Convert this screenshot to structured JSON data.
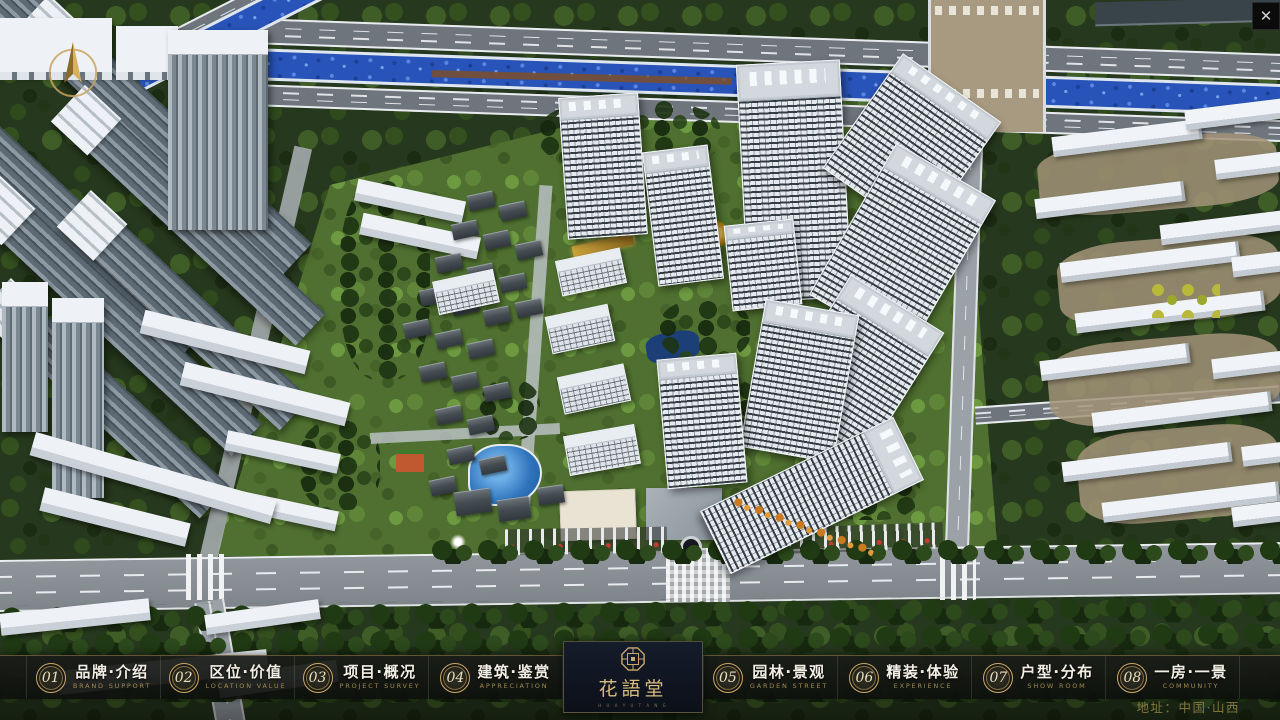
{
  "navbar": {
    "items": [
      {
        "num": "01",
        "label": "品牌·介绍",
        "sub": "BRAND SUPPORT"
      },
      {
        "num": "02",
        "label": "区位·价值",
        "sub": "LOCATION VALUE"
      },
      {
        "num": "03",
        "label": "项目·概况",
        "sub": "PROJECT SURVEY"
      },
      {
        "num": "04",
        "label": "建筑·鉴赏",
        "sub": "APPRECIATION"
      },
      {
        "num": "05",
        "label": "园林·景观",
        "sub": "GARDEN STREET"
      },
      {
        "num": "06",
        "label": "精装·体验",
        "sub": "EXPERIENCE"
      },
      {
        "num": "07",
        "label": "户型·分布",
        "sub": "SHOW ROOM"
      },
      {
        "num": "08",
        "label": "一房·一景",
        "sub": "COMMUNITY"
      }
    ]
  },
  "logo": {
    "title": "花語堂",
    "subtitle": "H U A Y U T A N G"
  },
  "footer": {
    "address": "地址：中国·山西"
  },
  "ui": {
    "close_glyph": "✕"
  },
  "palette": {
    "gold": "#c9a96a",
    "bar_bg": "#14160f",
    "logo_bg": "#0d1420",
    "river": "#2853b8",
    "lawn": "#4f7030",
    "forest": "#26381d",
    "road": "#8f959c"
  }
}
